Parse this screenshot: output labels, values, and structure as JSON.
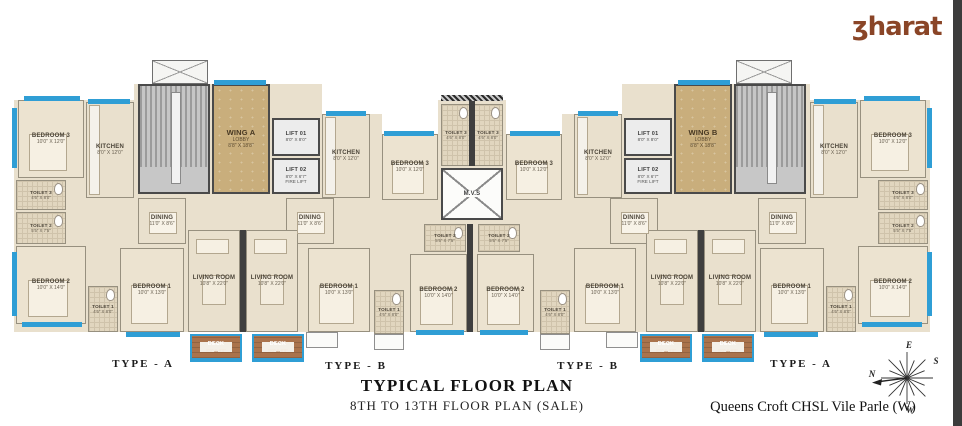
{
  "meta": {
    "title_line1": "TYPICAL FLOOR PLAN",
    "title_line2": "8TH TO 13TH FLOOR PLAN (SALE)",
    "project_name": "Queens Croft CHSL Vile Parle (W)"
  },
  "brand": {
    "text": "ʒharat"
  },
  "compass": {
    "top": "E",
    "left": "N",
    "bottom": "W",
    "right": "S"
  },
  "colors": {
    "window": "#2f9ed5",
    "wall": "#3f3f3f",
    "floor": "#e9e0cd",
    "lobby": "#c9ae7c",
    "deck": "#aa734c",
    "brand": "#8a4527"
  },
  "type_labels": [
    {
      "label": "TYPE - A",
      "x": 143,
      "y": 358
    },
    {
      "label": "TYPE - B",
      "x": 356,
      "y": 360
    },
    {
      "label": "TYPE - B",
      "x": 588,
      "y": 360
    },
    {
      "label": "TYPE - A",
      "x": 801,
      "y": 358
    }
  ],
  "base": [
    [
      14,
      100,
      124,
      232
    ],
    [
      134,
      84,
      188,
      248
    ],
    [
      322,
      114,
      60,
      218
    ],
    [
      380,
      134,
      60,
      198
    ],
    [
      438,
      100,
      68,
      232
    ],
    [
      562,
      114,
      60,
      218
    ],
    [
      504,
      134,
      60,
      198
    ],
    [
      622,
      84,
      188,
      248
    ],
    [
      806,
      100,
      124,
      232
    ]
  ],
  "rooms": [
    {
      "id": "bedroom3-la",
      "name": "BEDROOM 3",
      "dims": "10'0\" X 12'0\"",
      "kind": "bedroom",
      "x": 18,
      "y": 100,
      "w": 66,
      "h": 78
    },
    {
      "id": "kitchen-la",
      "name": "KITCHEN",
      "dims": "8'0\" X 12'0\"",
      "kind": "kitchen",
      "x": 86,
      "y": 102,
      "w": 48,
      "h": 96
    },
    {
      "id": "toilet3-la",
      "name": "TOILET 3",
      "dims": "4'6\" X 8'0\"",
      "kind": "toilet",
      "x": 16,
      "y": 180,
      "w": 50,
      "h": 30
    },
    {
      "id": "toilet2-la",
      "name": "TOILET 2",
      "dims": "5'5\" X 7'5\"",
      "kind": "toilet",
      "x": 16,
      "y": 212,
      "w": 50,
      "h": 32
    },
    {
      "id": "bedroom2-la",
      "name": "BEDROOM 2",
      "dims": "10'0\" X 14'0\"",
      "kind": "bedroom",
      "x": 16,
      "y": 246,
      "w": 70,
      "h": 78
    },
    {
      "id": "toilet1-la",
      "name": "TOILET 1",
      "dims": "4'6\" X 8'0\"",
      "kind": "toilet",
      "x": 88,
      "y": 286,
      "w": 30,
      "h": 46
    },
    {
      "id": "bedroom1-la",
      "name": "BEDROOM 1",
      "dims": "10'0\" X 13'0\"",
      "kind": "bedroom",
      "x": 120,
      "y": 248,
      "w": 64,
      "h": 84
    },
    {
      "id": "dining-la",
      "name": "DINING",
      "dims": "11'0\" X 8'6\"",
      "kind": "dining",
      "x": 138,
      "y": 198,
      "w": 48,
      "h": 46
    },
    {
      "id": "living-la",
      "name": "LIVING ROOM",
      "dims": "10'8\" X 22'0\"",
      "kind": "living",
      "x": 188,
      "y": 230,
      "w": 52,
      "h": 102
    },
    {
      "id": "deck-la",
      "name": "DECK",
      "dims": "8'0\" X 8'0\"",
      "kind": "deck",
      "x": 190,
      "y": 334,
      "w": 52,
      "h": 26
    },
    {
      "id": "passage-la",
      "kind": "passage",
      "x": 86,
      "y": 198,
      "w": 34,
      "h": 88
    },
    {
      "id": "passage-la2",
      "kind": "passage",
      "x": 66,
      "y": 180,
      "w": 20,
      "h": 66
    },
    {
      "id": "duct-a",
      "kind": "duct",
      "x": 152,
      "y": 60,
      "w": 56,
      "h": 24
    },
    {
      "id": "stairs-a",
      "kind": "stairs",
      "x": 138,
      "y": 84,
      "w": 72,
      "h": 110
    },
    {
      "id": "lobby-a",
      "name": "WING A",
      "sub": "LOBBY",
      "dims": "8'8\" X 18'8\"",
      "kind": "lobby",
      "x": 212,
      "y": 84,
      "w": 58,
      "h": 110
    },
    {
      "id": "lift1-a",
      "name": "LIFT 01",
      "dims": "8'0\" X 8'0\"",
      "kind": "lift",
      "x": 272,
      "y": 118,
      "w": 48,
      "h": 38
    },
    {
      "id": "lift2-a",
      "name": "LIFT 02",
      "dims": "8'0\" X 6'7\"",
      "sub2": "FIRE LIFT",
      "kind": "lift",
      "x": 272,
      "y": 158,
      "w": 48,
      "h": 36
    },
    {
      "id": "kitchen-lb",
      "name": "KITCHEN",
      "dims": "8'0\" X 12'0\"",
      "kind": "kitchen",
      "x": 322,
      "y": 114,
      "w": 48,
      "h": 84
    },
    {
      "id": "bedroom3-lb",
      "name": "BEDROOM 3",
      "dims": "10'0\" X 12'0\"",
      "kind": "bedroom",
      "x": 382,
      "y": 134,
      "w": 56,
      "h": 66
    },
    {
      "id": "toilet3-l",
      "name": "TOILET 3",
      "dims": "4'6\" X 8'0\"",
      "kind": "toilet",
      "x": 441,
      "y": 104,
      "w": 30,
      "h": 62
    },
    {
      "id": "toilet3-r",
      "name": "TOILET 3",
      "dims": "4'6\" X 8'0\"",
      "kind": "toilet",
      "x": 473,
      "y": 104,
      "w": 30,
      "h": 62
    },
    {
      "id": "mvs",
      "name": "M.V.S",
      "kind": "shaft",
      "x": 441,
      "y": 168,
      "w": 62,
      "h": 52
    },
    {
      "id": "dining-lb",
      "name": "DINING",
      "dims": "11'0\" X 8'6\"",
      "kind": "dining",
      "x": 286,
      "y": 198,
      "w": 48,
      "h": 46
    },
    {
      "id": "living-lb",
      "name": "LIVING ROOM",
      "dims": "10'8\" X 22'0\"",
      "kind": "living",
      "x": 246,
      "y": 230,
      "w": 52,
      "h": 102
    },
    {
      "id": "bedroom1-lb",
      "name": "BEDROOM 1",
      "dims": "10'0\" X 13'0\"",
      "kind": "bedroom",
      "x": 308,
      "y": 248,
      "w": 62,
      "h": 84
    },
    {
      "id": "toilet1-lb",
      "name": "TOILET 1",
      "dims": "4'6\" X 8'0\"",
      "kind": "toilet",
      "x": 374,
      "y": 290,
      "w": 30,
      "h": 44
    },
    {
      "id": "toilet2-lb",
      "name": "TOILET 2",
      "dims": "5'5\" X 7'5\"",
      "kind": "toilet",
      "x": 424,
      "y": 224,
      "w": 42,
      "h": 28
    },
    {
      "id": "bedroom2-lb",
      "name": "BEDROOM 2",
      "dims": "10'0\" X 14'0\"",
      "kind": "bedroom",
      "x": 410,
      "y": 254,
      "w": 57,
      "h": 78
    },
    {
      "id": "deck-lb",
      "name": "DECK",
      "dims": "8'0\" X 8'0\"",
      "kind": "deck",
      "x": 252,
      "y": 334,
      "w": 52,
      "h": 26
    },
    {
      "id": "duct-b",
      "kind": "duct",
      "x": 736,
      "y": 60,
      "w": 56,
      "h": 24
    },
    {
      "id": "stairs-b",
      "kind": "stairs",
      "x": 734,
      "y": 84,
      "w": 72,
      "h": 110
    },
    {
      "id": "lobby-b",
      "name": "WING B",
      "sub": "LOBBY",
      "dims": "8'8\" X 18'8\"",
      "kind": "lobby",
      "x": 674,
      "y": 84,
      "w": 58,
      "h": 110
    },
    {
      "id": "lift1-b",
      "name": "LIFT 01",
      "dims": "8'0\" X 8'0\"",
      "kind": "lift",
      "x": 624,
      "y": 118,
      "w": 48,
      "h": 38
    },
    {
      "id": "lift2-b",
      "name": "LIFT 02",
      "dims": "8'0\" X 6'7\"",
      "sub2": "FIRE LIFT",
      "kind": "lift",
      "x": 624,
      "y": 158,
      "w": 48,
      "h": 36
    },
    {
      "id": "kitchen-rb",
      "name": "KITCHEN",
      "dims": "8'0\" X 12'0\"",
      "kind": "kitchen",
      "x": 574,
      "y": 114,
      "w": 48,
      "h": 84
    },
    {
      "id": "bedroom3-rb",
      "name": "BEDROOM 3",
      "dims": "10'0\" X 12'0\"",
      "kind": "bedroom",
      "x": 506,
      "y": 134,
      "w": 56,
      "h": 66
    },
    {
      "id": "dining-rb",
      "name": "DINING",
      "dims": "11'0\" X 8'6\"",
      "kind": "dining",
      "x": 610,
      "y": 198,
      "w": 48,
      "h": 46
    },
    {
      "id": "living-rb",
      "name": "LIVING ROOM",
      "dims": "10'8\" X 22'0\"",
      "kind": "living",
      "x": 646,
      "y": 230,
      "w": 52,
      "h": 102
    },
    {
      "id": "bedroom1-rb",
      "name": "BEDROOM 1",
      "dims": "10'0\" X 13'0\"",
      "kind": "bedroom",
      "x": 574,
      "y": 248,
      "w": 62,
      "h": 84
    },
    {
      "id": "toilet1-rb",
      "name": "TOILET 1",
      "dims": "4'6\" X 8'0\"",
      "kind": "toilet",
      "x": 540,
      "y": 290,
      "w": 30,
      "h": 44
    },
    {
      "id": "toilet2-rb",
      "name": "TOILET 2",
      "dims": "5'5\" X 7'5\"",
      "kind": "toilet",
      "x": 478,
      "y": 224,
      "w": 42,
      "h": 28
    },
    {
      "id": "bedroom2-rb",
      "name": "BEDROOM 2",
      "dims": "10'0\" X 14'0\"",
      "kind": "bedroom",
      "x": 477,
      "y": 254,
      "w": 57,
      "h": 78
    },
    {
      "id": "deck-rb",
      "name": "DECK",
      "dims": "8'0\" X 8'0\"",
      "kind": "deck",
      "x": 640,
      "y": 334,
      "w": 52,
      "h": 26
    },
    {
      "id": "bedroom3-ra",
      "name": "BEDROOM 3",
      "dims": "10'0\" X 12'0\"",
      "kind": "bedroom",
      "x": 860,
      "y": 100,
      "w": 66,
      "h": 78
    },
    {
      "id": "kitchen-ra",
      "name": "KITCHEN",
      "dims": "8'0\" X 12'0\"",
      "kind": "kitchen",
      "x": 810,
      "y": 102,
      "w": 48,
      "h": 96
    },
    {
      "id": "toilet3-ra",
      "name": "TOILET 3",
      "dims": "4'6\" X 8'0\"",
      "kind": "toilet",
      "x": 878,
      "y": 180,
      "w": 50,
      "h": 30
    },
    {
      "id": "toilet2-ra",
      "name": "TOILET 2",
      "dims": "5'5\" X 7'5\"",
      "kind": "toilet",
      "x": 878,
      "y": 212,
      "w": 50,
      "h": 32
    },
    {
      "id": "bedroom2-ra",
      "name": "BEDROOM 2",
      "dims": "10'0\" X 14'0\"",
      "kind": "bedroom",
      "x": 858,
      "y": 246,
      "w": 70,
      "h": 78
    },
    {
      "id": "toilet1-ra",
      "name": "TOILET 1",
      "dims": "4'6\" X 8'0\"",
      "kind": "toilet",
      "x": 826,
      "y": 286,
      "w": 30,
      "h": 46
    },
    {
      "id": "bedroom1-ra",
      "name": "BEDROOM 1",
      "dims": "10'0\" X 13'0\"",
      "kind": "bedroom",
      "x": 760,
      "y": 248,
      "w": 64,
      "h": 84
    },
    {
      "id": "dining-ra",
      "name": "DINING",
      "dims": "11'0\" X 8'6\"",
      "kind": "dining",
      "x": 758,
      "y": 198,
      "w": 48,
      "h": 46
    },
    {
      "id": "living-ra",
      "name": "LIVING ROOM",
      "dims": "10'8\" X 22'0\"",
      "kind": "living",
      "x": 704,
      "y": 230,
      "w": 52,
      "h": 102
    },
    {
      "id": "deck-ra",
      "name": "DECK",
      "dims": "8'0\" X 8'0\"",
      "kind": "deck",
      "x": 702,
      "y": 334,
      "w": 52,
      "h": 26
    },
    {
      "id": "passage-ra",
      "kind": "passage",
      "x": 824,
      "y": 198,
      "w": 34,
      "h": 88
    },
    {
      "id": "passage-ra2",
      "kind": "passage",
      "x": 858,
      "y": 180,
      "w": 20,
      "h": 66
    }
  ],
  "windows": [
    [
      24,
      96,
      56,
      5
    ],
    [
      12,
      108,
      5,
      60
    ],
    [
      12,
      252,
      5,
      64
    ],
    [
      22,
      322,
      60,
      5
    ],
    [
      126,
      332,
      54,
      5
    ],
    [
      214,
      80,
      52,
      5
    ],
    [
      88,
      99,
      42,
      5
    ],
    [
      326,
      111,
      40,
      5
    ],
    [
      384,
      131,
      50,
      5
    ],
    [
      416,
      330,
      48,
      5
    ],
    [
      190,
      358,
      52,
      4
    ],
    [
      252,
      358,
      52,
      4
    ],
    [
      864,
      96,
      56,
      5
    ],
    [
      927,
      108,
      5,
      60
    ],
    [
      927,
      252,
      5,
      64
    ],
    [
      862,
      322,
      60,
      5
    ],
    [
      764,
      332,
      54,
      5
    ],
    [
      678,
      80,
      52,
      5
    ],
    [
      814,
      99,
      42,
      5
    ],
    [
      578,
      111,
      40,
      5
    ],
    [
      510,
      131,
      50,
      5
    ],
    [
      480,
      330,
      48,
      5
    ],
    [
      702,
      358,
      52,
      4
    ],
    [
      640,
      358,
      52,
      4
    ]
  ],
  "walls": [
    [
      240,
      230,
      6,
      102
    ],
    [
      698,
      230,
      6,
      102
    ],
    [
      467,
      224,
      6,
      108
    ],
    [
      469,
      100,
      6,
      66
    ]
  ],
  "hatches": [
    [
      441,
      95,
      62,
      6
    ]
  ],
  "ledges": [
    [
      306,
      332,
      32,
      16
    ],
    [
      374,
      334,
      30,
      16
    ],
    [
      606,
      332,
      32,
      16
    ],
    [
      540,
      334,
      30,
      16
    ]
  ]
}
